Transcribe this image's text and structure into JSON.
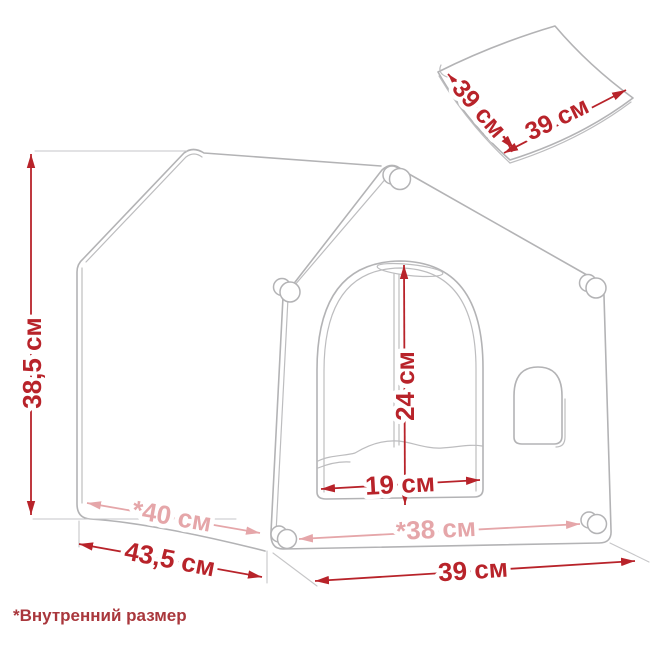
{
  "diagram": {
    "footnote": "*Внутренний размер",
    "labels": {
      "height": "38,5 см",
      "depth_outer": "43,5 см",
      "depth_inner": "*40 см",
      "door_height": "24 см",
      "door_width": "19 см",
      "width_inner": "*38 см",
      "width_outer": "39 см",
      "mat_side": "39 см",
      "mat_depth": "39 см"
    },
    "colors": {
      "dimension_red": "#b8232a",
      "dimension_pink": "#e5a6a9",
      "line_gray": "#b3b3b5",
      "footnote_red": "#a9373c"
    }
  }
}
